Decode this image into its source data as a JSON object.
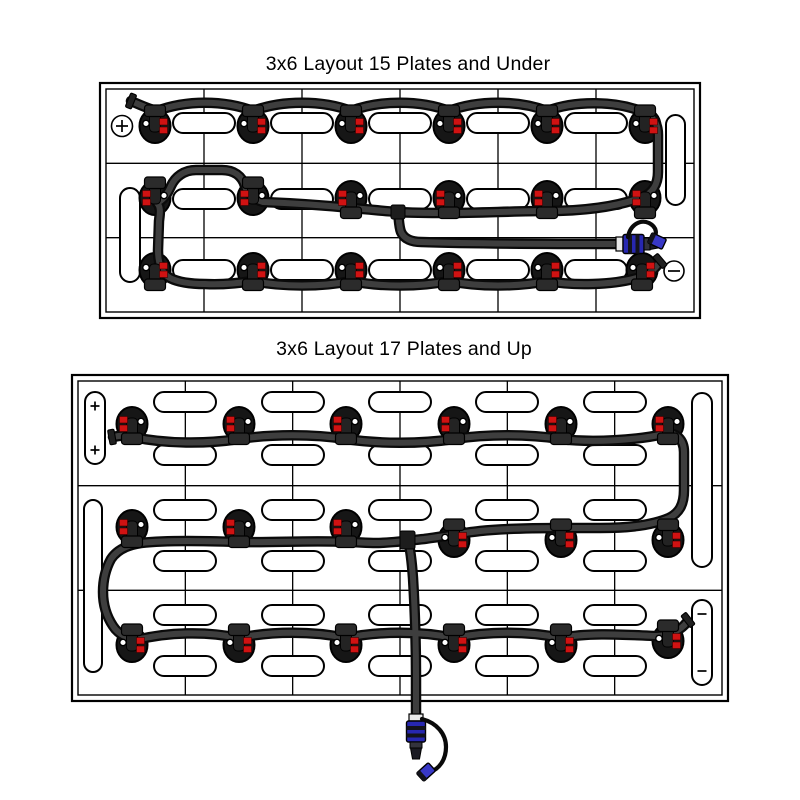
{
  "page": {
    "background": "#ffffff",
    "width": 800,
    "height": 800
  },
  "colors": {
    "line": "#000000",
    "tube_casing": "#0a0a0a",
    "tube_core": "#3e3e3e",
    "valve_body": "#161616",
    "valve_cap": "#2b2b2b",
    "valve_tab": "#232323",
    "red_indicator": "#d01212",
    "red_dark": "#3f0000",
    "white_dot": "#ffffff",
    "connector_blue": "#2727b0",
    "cap_blue": "#3838c6",
    "band_dark": "#13131b",
    "collar": "#e9e9e9",
    "metal": "#33333d",
    "tip": "#1a1a22",
    "clamp": "#202020"
  },
  "diagrams": [
    {
      "name": "layout-15-plates-and-under",
      "title": "3x6 Layout 15 Plates and Under",
      "box": {
        "x": 100,
        "y": 83,
        "w": 600,
        "h": 235,
        "inset": 6
      },
      "grid": {
        "cols": 6,
        "rows": 3
      },
      "h_pill": {
        "w": 62,
        "h": 20
      },
      "h_pill_rows": [
        {
          "y": 123,
          "xs": [
            204,
            302,
            400,
            498,
            596
          ]
        },
        {
          "y": 199,
          "xs": [
            204,
            302,
            400,
            498,
            596
          ]
        },
        {
          "y": 270,
          "xs": [
            204,
            302,
            400,
            498,
            596
          ]
        }
      ],
      "v_pills": [
        {
          "x": 120,
          "y": 188,
          "w": 20,
          "h": 94
        },
        {
          "x": 666,
          "y": 115,
          "w": 19,
          "h": 90
        }
      ],
      "terminals": [
        {
          "sign": "plus",
          "x": 122,
          "y": 126,
          "circle": true,
          "r": 10.5,
          "s": 6
        },
        {
          "sign": "minus",
          "x": 674,
          "y": 271,
          "circle": true,
          "r": 10,
          "s": 6
        }
      ],
      "valves": [
        {
          "x": 155,
          "y": 126,
          "red": "right",
          "cap": "top"
        },
        {
          "x": 253,
          "y": 126,
          "red": "right",
          "cap": "top"
        },
        {
          "x": 351,
          "y": 126,
          "red": "right",
          "cap": "top"
        },
        {
          "x": 449,
          "y": 126,
          "red": "right",
          "cap": "top"
        },
        {
          "x": 547,
          "y": 126,
          "red": "right",
          "cap": "top"
        },
        {
          "x": 645,
          "y": 126,
          "red": "right",
          "cap": "top"
        },
        {
          "x": 155,
          "y": 198,
          "red": "left",
          "cap": "top"
        },
        {
          "x": 253,
          "y": 198,
          "red": "left",
          "cap": "top"
        },
        {
          "x": 351,
          "y": 198,
          "red": "left",
          "cap": "bottom"
        },
        {
          "x": 449,
          "y": 198,
          "red": "left",
          "cap": "bottom"
        },
        {
          "x": 547,
          "y": 198,
          "red": "left",
          "cap": "bottom"
        },
        {
          "x": 645,
          "y": 198,
          "red": "left",
          "cap": "bottom"
        },
        {
          "x": 155,
          "y": 270,
          "red": "right",
          "cap": "bottom"
        },
        {
          "x": 253,
          "y": 270,
          "red": "right",
          "cap": "bottom"
        },
        {
          "x": 351,
          "y": 270,
          "red": "right",
          "cap": "bottom"
        },
        {
          "x": 449,
          "y": 270,
          "red": "right",
          "cap": "bottom"
        },
        {
          "x": 547,
          "y": 270,
          "red": "right",
          "cap": "bottom"
        },
        {
          "x": 642,
          "y": 270,
          "red": "right",
          "cap": "bottom"
        }
      ],
      "tubes": [
        "M 131 101 C 140 105, 149 109, 157 111 C 186 100, 224 100, 253 111 C 282 100, 322 100, 351 111 C 380 100, 420 100, 449 111 C 478 100, 518 100, 547 111 C 576 100, 617 101, 643 112 C 654 117, 658 124, 658 135 L 658 172 C 658 185, 652 193, 643 197 C 614 208, 578 211, 547 211 C 517 211, 479 213, 449 213 C 431 213, 413 213, 398 212 C 382 211, 366 209, 351 208 C 321 205, 288 203, 263 202 C 253 199, 247 193, 245 186 C 242 176, 234 170, 222 170 L 196 170 C 184 170, 175 177, 171 186 C 167 195, 163 200, 157 203 C 161 207, 160 213, 159 221 L 158 250 C 158 263, 161 273, 170 278 C 178 282, 190 284, 205 284 C 223 285, 240 283, 253 281 C 282 287, 322 287, 351 281 C 380 287, 420 287, 449 281 C 478 287, 518 287, 547 281 C 574 286, 612 285, 637 278 C 648 275, 655 269, 659 263",
        "M 398 212 C 399 220, 399 227, 401 232 C 404 239, 412 242, 421 242 C 480 244, 552 244, 617 244"
      ],
      "t_blocks": [
        {
          "x": 391,
          "y": 205,
          "w": 14,
          "h": 14
        }
      ],
      "end_clamps": [
        {
          "x": 131,
          "y": 101,
          "a": 22
        },
        {
          "x": 660,
          "y": 261,
          "a": -40
        }
      ],
      "connector": {
        "x": 616,
        "y": 244,
        "rotate": 0,
        "tether": "M 628 237 C 630 225, 640 219, 649 223 C 657 227, 658 235, 652 239",
        "cap": {
          "x": 657,
          "y": 241,
          "a": 25
        }
      }
    },
    {
      "name": "layout-17-plates-and-up",
      "title": "3x6 Layout 17 Plates and Up",
      "box": {
        "x": 72,
        "y": 375,
        "w": 656,
        "h": 326,
        "inset": 6
      },
      "grid": {
        "cols": 6,
        "rows": 3
      },
      "h_pill": {
        "w": 62,
        "h": 20
      },
      "h_pill_rows": [
        {
          "y": 402,
          "xs": [
            185,
            293,
            400,
            507,
            615
          ]
        },
        {
          "y": 455,
          "xs": [
            185,
            293,
            400,
            507,
            615
          ]
        },
        {
          "y": 510,
          "xs": [
            185,
            293,
            400,
            507,
            615
          ]
        },
        {
          "y": 561,
          "xs": [
            185,
            293,
            400,
            507,
            615
          ]
        },
        {
          "y": 615,
          "xs": [
            185,
            293,
            400,
            507,
            615
          ]
        },
        {
          "y": 666,
          "xs": [
            185,
            293,
            400,
            507,
            615
          ]
        }
      ],
      "v_pills": [
        {
          "x": 85,
          "y": 392,
          "w": 20,
          "h": 72
        },
        {
          "x": 84,
          "y": 500,
          "w": 18,
          "h": 172
        },
        {
          "x": 692,
          "y": 393,
          "w": 20,
          "h": 174
        },
        {
          "x": 692,
          "y": 600,
          "w": 20,
          "h": 85
        }
      ],
      "terminals": [
        {
          "sign": "plus",
          "x": 95,
          "y": 406,
          "circle": false,
          "s": 4.5
        },
        {
          "sign": "plus",
          "x": 95,
          "y": 450,
          "circle": false,
          "s": 4.5
        },
        {
          "sign": "minus",
          "x": 702,
          "y": 614,
          "circle": false,
          "s": 4.5
        },
        {
          "sign": "minus",
          "x": 702,
          "y": 671,
          "circle": false,
          "s": 4.5
        }
      ],
      "valves": [
        {
          "x": 132,
          "y": 424,
          "red": "left",
          "cap": "bottom"
        },
        {
          "x": 239,
          "y": 424,
          "red": "left",
          "cap": "bottom"
        },
        {
          "x": 346,
          "y": 424,
          "red": "left",
          "cap": "bottom"
        },
        {
          "x": 454,
          "y": 424,
          "red": "left",
          "cap": "bottom"
        },
        {
          "x": 561,
          "y": 424,
          "red": "left",
          "cap": "bottom"
        },
        {
          "x": 668,
          "y": 424,
          "red": "left",
          "cap": "bottom"
        },
        {
          "x": 132,
          "y": 527,
          "red": "left",
          "cap": "bottom"
        },
        {
          "x": 239,
          "y": 527,
          "red": "left",
          "cap": "bottom"
        },
        {
          "x": 346,
          "y": 527,
          "red": "left",
          "cap": "bottom"
        },
        {
          "x": 454,
          "y": 540,
          "red": "right",
          "cap": "top"
        },
        {
          "x": 561,
          "y": 540,
          "red": "right",
          "cap": "top"
        },
        {
          "x": 668,
          "y": 540,
          "red": "right",
          "cap": "top"
        },
        {
          "x": 132,
          "y": 645,
          "red": "right",
          "cap": "top"
        },
        {
          "x": 239,
          "y": 645,
          "red": "right",
          "cap": "top"
        },
        {
          "x": 346,
          "y": 645,
          "red": "right",
          "cap": "top"
        },
        {
          "x": 454,
          "y": 645,
          "red": "right",
          "cap": "top"
        },
        {
          "x": 561,
          "y": 645,
          "red": "right",
          "cap": "top"
        },
        {
          "x": 668,
          "y": 641,
          "red": "right",
          "cap": "top"
        }
      ],
      "tubes": [
        "M 113 437 C 121 435, 127 435, 133 437 C 166 444, 206 444, 239 439 C 272 434, 313 434, 346 439 C 379 444, 421 444, 454 439 C 487 434, 528 434, 561 439 C 592 443, 638 440, 664 434 C 676 431, 684 440, 684 452 L 684 490 C 684 505, 679 513, 669 518 C 648 527, 620 528, 600 528 C 585 528, 575 528, 561 528 C 535 528, 500 529, 480 531 C 462 533, 440 537, 424 539 C 404 541, 390 543, 376 543 C 366 543, 356 542, 346 542 C 312 540, 273 543, 239 542 C 206 541, 168 540, 141 543 C 127 545, 117 550, 111 559 C 105 570, 103 581, 103 592 C 103 605, 107 617, 113 626 C 118 634, 127 638, 136 640 C 168 632, 206 631, 239 638 C 272 631, 313 631, 346 638 C 379 631, 421 631, 454 638 C 487 631, 528 631, 561 638 C 590 632, 628 635, 656 636 C 670 636, 681 630, 687 622",
        "M 408 540 C 411 552, 412 564, 413 578 C 415 612, 416 645, 416 675 L 416 716"
      ],
      "t_blocks": [
        {
          "x": 400,
          "y": 531,
          "w": 15,
          "h": 18
        }
      ],
      "end_clamps": [
        {
          "x": 112,
          "y": 437,
          "a": -10
        },
        {
          "x": 688,
          "y": 620,
          "a": -38
        }
      ],
      "connector": {
        "x": 416,
        "y": 714,
        "rotate": 90,
        "tether": "M 422 719 C 437 723, 446 734, 446 747 C 446 760, 439 769, 430 772",
        "cap": {
          "x": 426,
          "y": 772,
          "a": -42
        }
      }
    }
  ]
}
